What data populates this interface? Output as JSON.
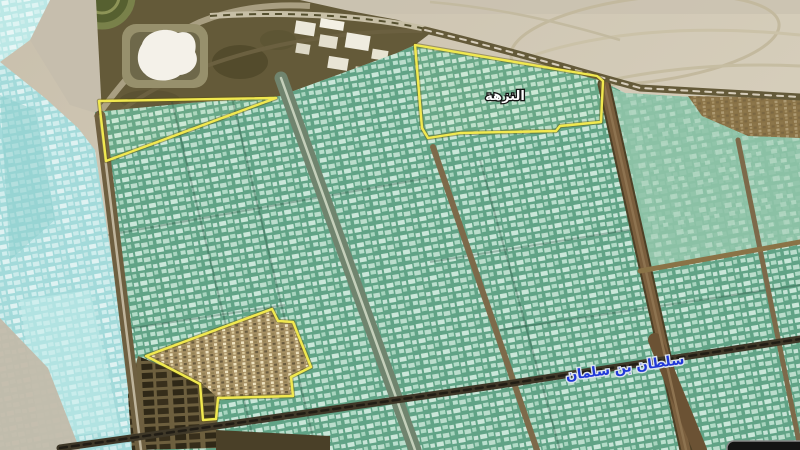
{
  "labels": {
    "district": "النزهة",
    "street": "سلطان بن سلمان"
  },
  "zones": [
    {
      "name": "northwest-strip-zone"
    },
    {
      "name": "al-nuzha-district-zone"
    },
    {
      "name": "old-town-quarter-zone"
    }
  ],
  "colors": {
    "desert": "#cfc6b2",
    "desert_light": "#d8d0bd",
    "olive_band": "#645a39",
    "gray_corridor": "#c6bead",
    "teal_urban": "#61a386",
    "teal_flat": "#8fc3a8",
    "cyan_urban": "#a3dada",
    "cyan_light": "#bce8e6",
    "old_town": "#a38c63",
    "warehouse_dark": "#6d5f3e",
    "brown_patch": "#8a7347",
    "road_brown": "#7d6a4a",
    "road_dark": "#3f3828",
    "boulevard": "#70846e",
    "boulevard_median": "#c4cfba",
    "boundary_yellow": "#f1e94f",
    "district_text": "#ffffff",
    "street_text": "#2038d8",
    "caption_bg": "#141414"
  }
}
